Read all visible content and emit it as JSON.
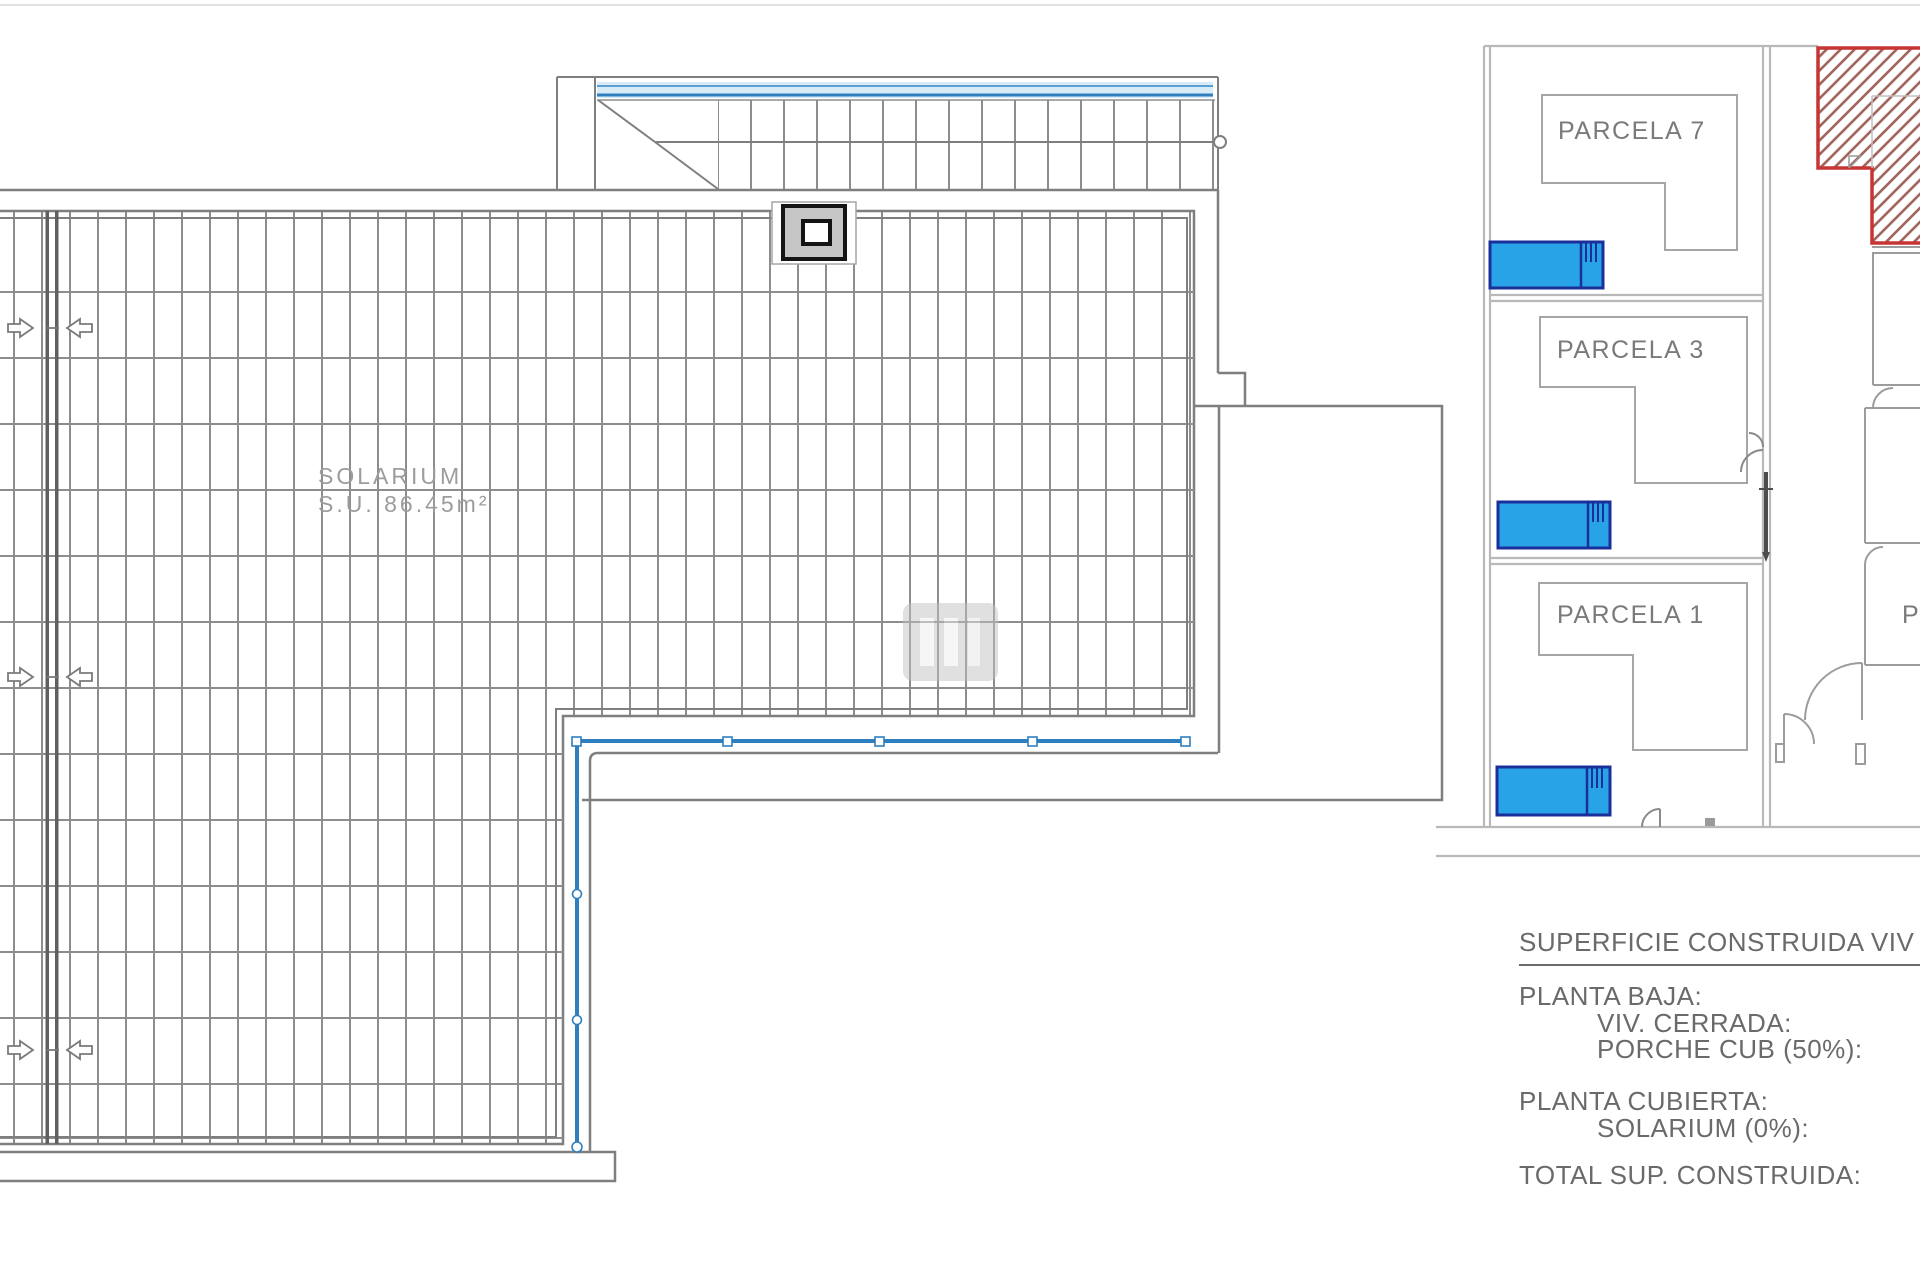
{
  "plan": {
    "solarium_line1": "SOLARIUM",
    "solarium_line2": "S.U. 86.45m²"
  },
  "site": {
    "parcel7": "PARCELA 7",
    "parcel3": "PARCELA 3",
    "parcel1": "PARCELA 1",
    "neighbor": "P"
  },
  "summary": {
    "title": "SUPERFICIE CONSTRUIDA VIV 3",
    "planta_baja": "PLANTA BAJA:",
    "viv_cerrada": "VIV. CERRADA:",
    "porche_cub": "PORCHE CUB (50%):",
    "planta_cubierta": "PLANTA CUBIERTA:",
    "solarium_pct": "SOLARIUM (0%):",
    "total": "TOTAL SUP. CONSTRUIDA:"
  },
  "colors": {
    "railing_blue": "#2e7fc0",
    "stair_band_blue": "#d8ecf8",
    "pool_fill": "#29a3e8",
    "pool_border": "#1b2f9b",
    "highlight_red": "#c63434",
    "plan_gray": "#7f7f7f"
  }
}
